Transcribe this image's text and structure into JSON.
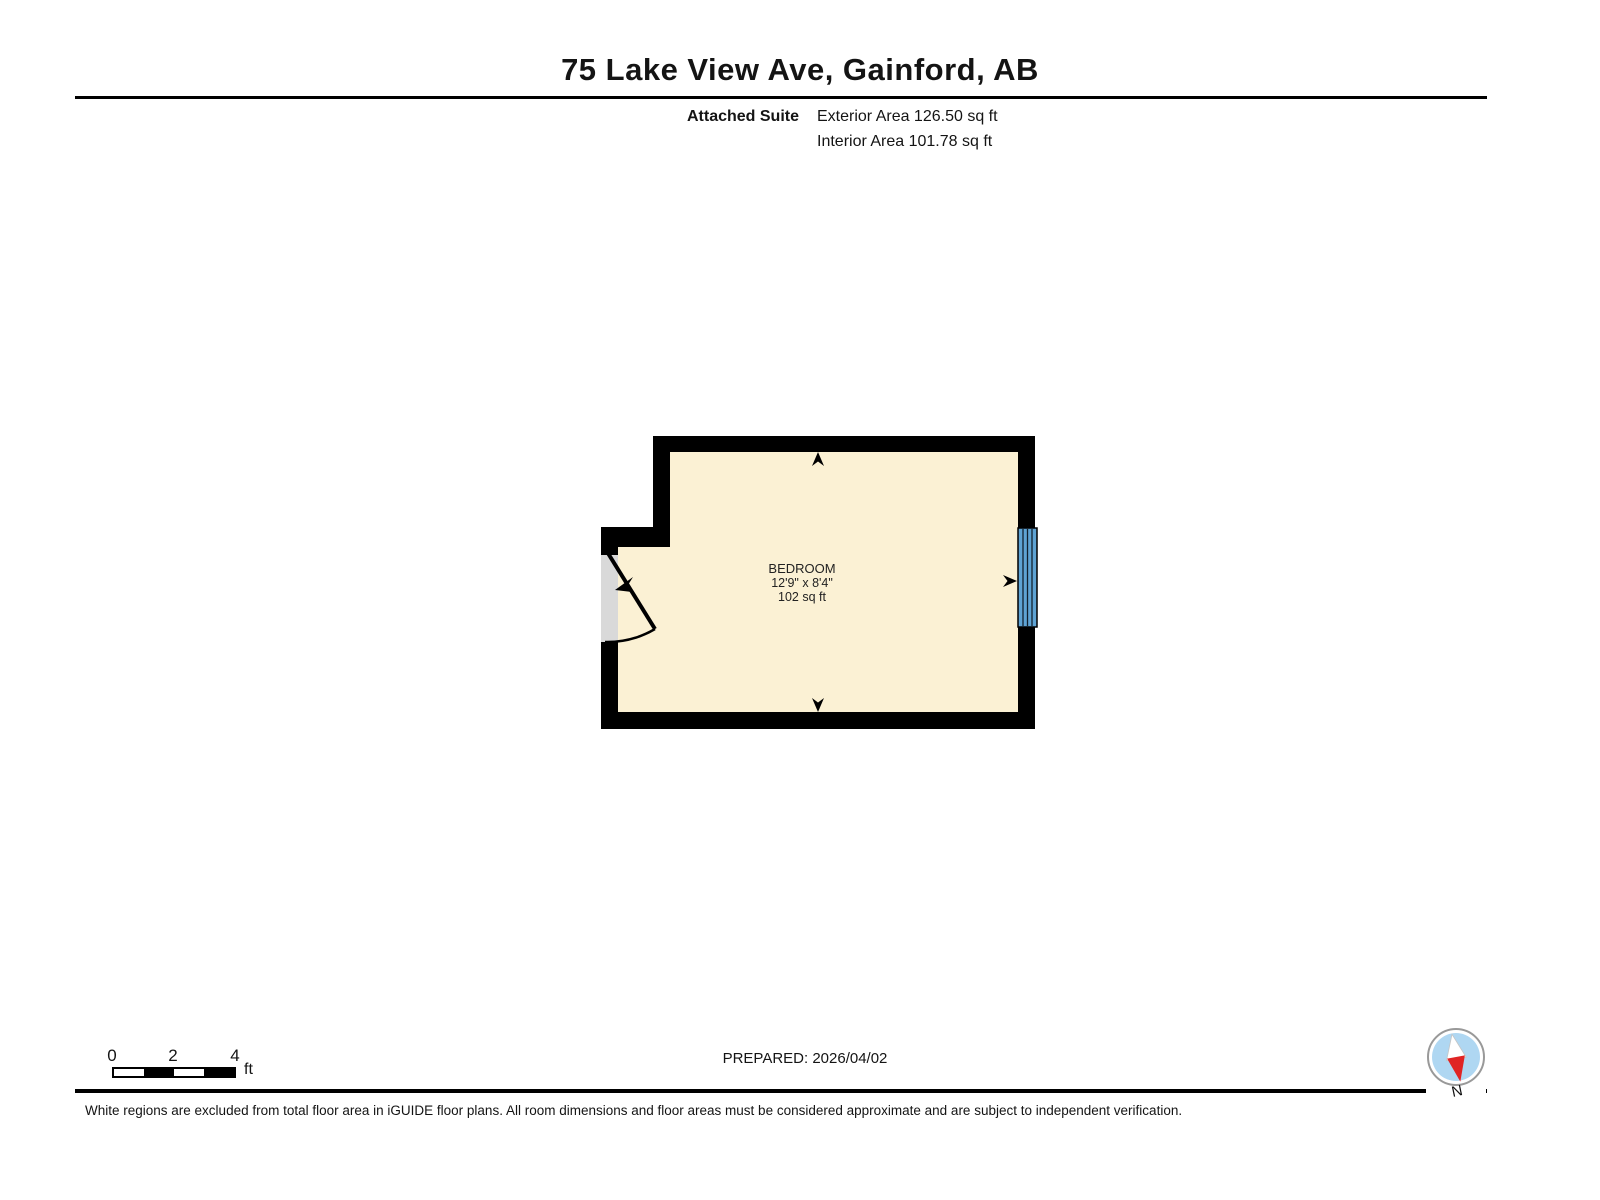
{
  "header": {
    "title": "75 Lake View Ave, Gainford, AB",
    "section_label": "Attached Suite",
    "exterior_area": "Exterior Area 126.50 sq ft",
    "interior_area": "Interior Area 101.78 sq ft"
  },
  "floorplan": {
    "room": {
      "name": "BEDROOM",
      "dimensions": "12'9\" x 8'4\"",
      "area": "102 sq ft"
    },
    "colors": {
      "wall": "#000000",
      "floor": "#FBF1D4",
      "window": "#5EA3D4",
      "door": "#D9D9D9"
    }
  },
  "footer": {
    "scale": {
      "ticks": [
        "0",
        "2",
        "4"
      ],
      "unit": "ft"
    },
    "prepared": "PREPARED: 2026/04/02",
    "compass": {
      "label": "N",
      "face_color": "#AFD7F2",
      "needle_color": "#E02424"
    },
    "disclaimer": "White regions are excluded from total floor area in iGUIDE floor plans. All room dimensions and floor areas must be considered approximate and are subject to independent verification."
  }
}
